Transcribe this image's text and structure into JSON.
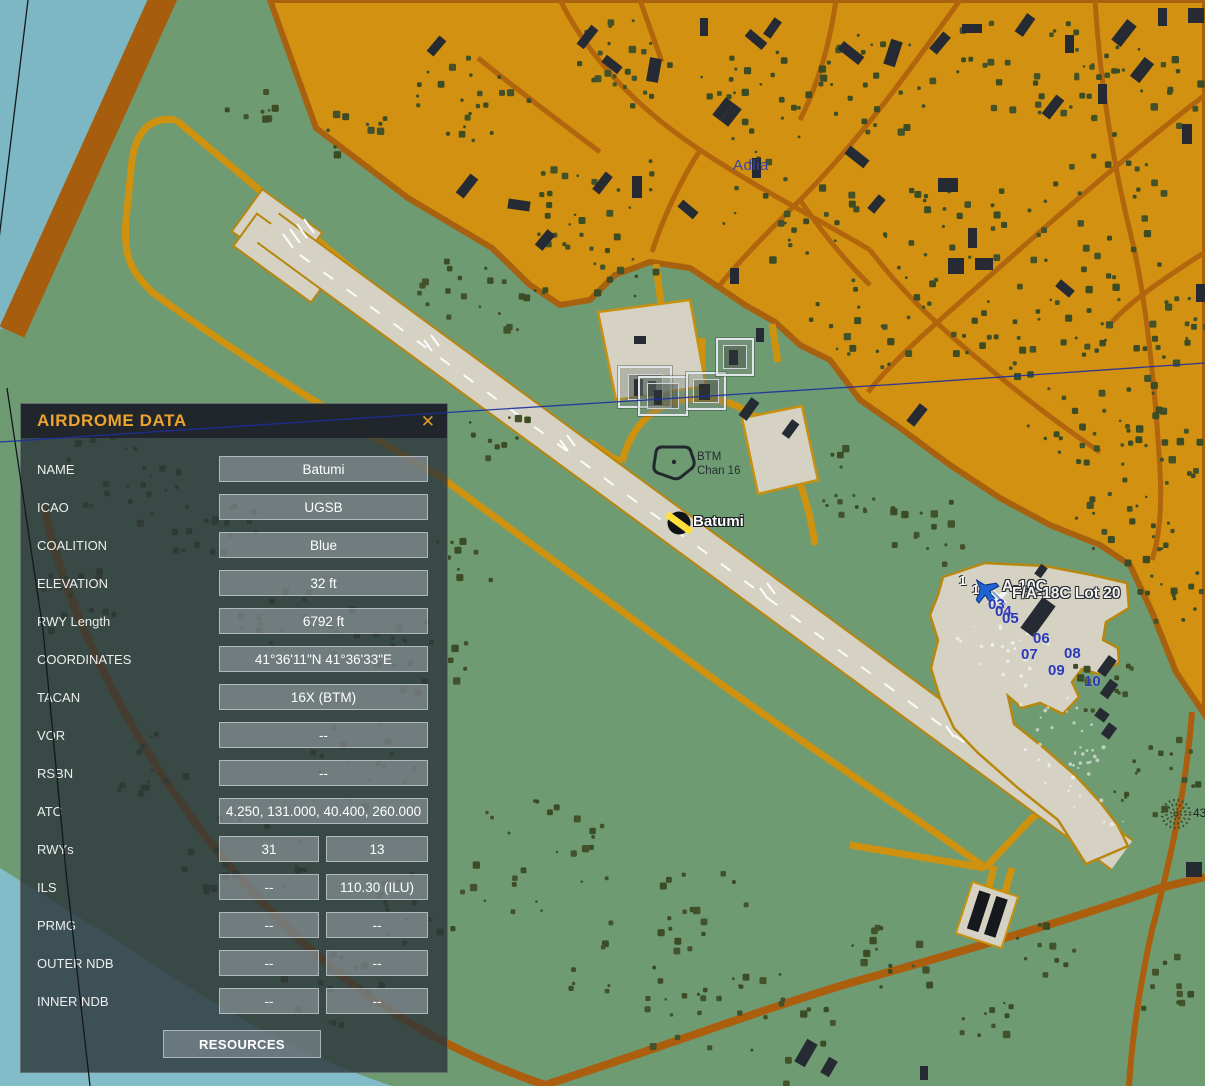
{
  "window": {
    "title": "AIRDROME DATA",
    "close_label": "✕"
  },
  "panel": {
    "fields": [
      {
        "label": "NAME",
        "values": [
          "Batumi"
        ]
      },
      {
        "label": "ICAO",
        "values": [
          "UGSB"
        ]
      },
      {
        "label": "COALITION",
        "values": [
          "Blue"
        ]
      },
      {
        "label": "ELEVATION",
        "values": [
          "32 ft"
        ]
      },
      {
        "label": "RWY Length",
        "values": [
          "6792 ft"
        ]
      },
      {
        "label": "COORDINATES",
        "values": [
          "41°36'11\"N 41°36'33\"E"
        ]
      },
      {
        "label": "TACAN",
        "values": [
          "16X (BTM)"
        ]
      },
      {
        "label": "VOR",
        "values": [
          "--"
        ]
      },
      {
        "label": "RSBN",
        "values": [
          "--"
        ]
      },
      {
        "label": "ATC",
        "values": [
          "4.250, 131.000, 40.400, 260.000"
        ]
      },
      {
        "label": "RWYs",
        "values": [
          "31",
          "13"
        ]
      },
      {
        "label": "ILS",
        "values": [
          "--",
          "110.30 (ILU)"
        ]
      },
      {
        "label": "PRMG",
        "values": [
          "--",
          "--"
        ]
      },
      {
        "label": "OUTER NDB",
        "values": [
          "--",
          "--"
        ]
      },
      {
        "label": "INNER NDB",
        "values": [
          "--",
          "--"
        ]
      }
    ],
    "resources_button": "RESOURCES"
  },
  "map": {
    "labels": {
      "town": "Adlia",
      "airport": "Batumi",
      "tacan_line1": "BTM",
      "tacan_line2": "Chan 16",
      "group1": "A-10C",
      "group2": "F/A-18C Lot 20",
      "group1_count": "1",
      "group2_count": "1",
      "spot_elevation": "43"
    },
    "parking_numbers": [
      "03",
      "04",
      "05",
      "06",
      "07",
      "08",
      "09",
      "10"
    ],
    "colors": {
      "water": "#7cb7c3",
      "land": "#6f9b73",
      "urban": "#d29110",
      "road_bright": "#cf920e",
      "road_dark": "#ab5f0e",
      "runway": "#d5d2c4",
      "building": "#262b33",
      "tree": "#42522a",
      "panel_accent": "#eda42c",
      "parking_number": "#2d38b8",
      "coalition_blue_icon": "#1e63d0"
    }
  }
}
